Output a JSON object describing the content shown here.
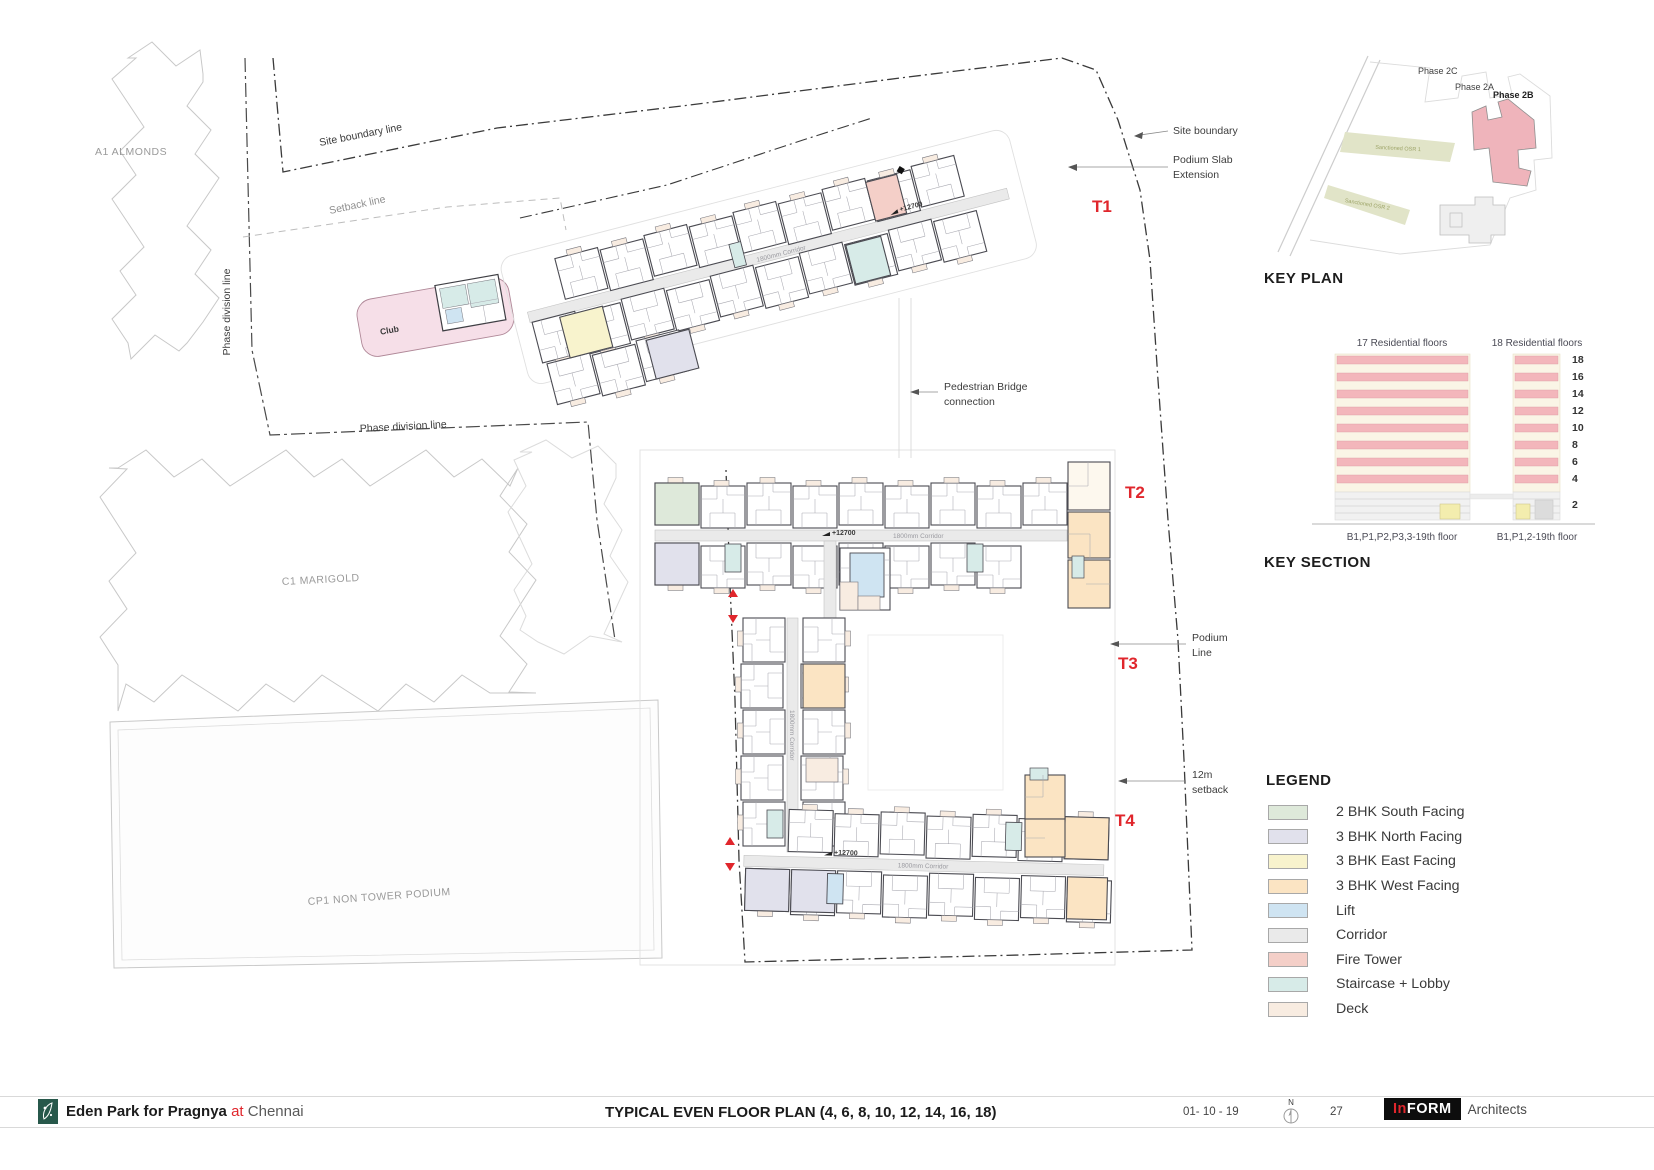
{
  "titlebar": {
    "project": "Eden Park for Pragnya",
    "at": "at",
    "city": "Chennai",
    "drawing_title": "TYPICAL EVEN FLOOR PLAN (4, 6, 8, 10, 12, 14, 16, 18)",
    "date": "01- 10 - 19",
    "north": "N",
    "sheet": "27",
    "firm_in": "In",
    "firm_form": "FORM",
    "firm_suffix": "Architects"
  },
  "key_plan": {
    "title": "KEY PLAN",
    "phase_2c": "Phase 2C",
    "phase_2a": "Phase 2A",
    "phase_2b": "Phase 2B",
    "osr1": "Sanctioned OSR 1",
    "osr2": "Sanctioned OSR 2",
    "highlight_color": "#efb4bb"
  },
  "key_section": {
    "title": "KEY SECTION",
    "left_header": "17 Residential floors",
    "right_header": "18 Residential floors",
    "left_caption": "B1,P1,P2,P3,3-19th floor",
    "right_caption": "B1,P1,2-19th floor",
    "floors": [
      "18",
      "16",
      "14",
      "12",
      "10",
      "8",
      "6",
      "4",
      "2"
    ],
    "band_color": "#f3b6bb",
    "body_color": "#faf5e6"
  },
  "legend": {
    "title": "LEGEND",
    "items": [
      {
        "label": "2 BHK South Facing",
        "color": "#dee9da"
      },
      {
        "label": "3 BHK North Facing",
        "color": "#e1e1ec"
      },
      {
        "label": "3 BHK East Facing",
        "color": "#f8f3cd"
      },
      {
        "label": "3 BHK West Facing",
        "color": "#fbe4c3"
      },
      {
        "label": "Lift",
        "color": "#cfe4f2"
      },
      {
        "label": "Corridor",
        "color": "#eaeaea"
      },
      {
        "label": "Fire Tower",
        "color": "#f4cfc8"
      },
      {
        "label": "Staircase + Lobby",
        "color": "#d7ebe8"
      },
      {
        "label": "Deck",
        "color": "#f8ece1"
      }
    ]
  },
  "plan": {
    "towers": {
      "t1": "T1",
      "t2": "T2",
      "t3": "T3",
      "t4": "T4"
    },
    "annotations": {
      "site_boundary": "Site boundary",
      "podium_slab_1": "Podium Slab",
      "podium_slab_2": "Extension",
      "pedestrian_1": "Pedestrian Bridge",
      "pedestrian_2": "connection",
      "podium_line_1": "Podium",
      "podium_line_2": "Line",
      "setback_12m_1": "12m",
      "setback_12m_2": "setback",
      "site_boundary_line": "Site boundary line",
      "setback_line": "Setback line",
      "phase_division_line": "Phase division line"
    },
    "context": {
      "a1": "A1 ALMONDS",
      "c1": "C1 MARIGOLD",
      "cp1": "CP1 NON TOWER PODIUM",
      "club": "Club"
    },
    "corridor_label": "1800mm Corridor",
    "level_marker": "+12700",
    "accent_red": "#e0262c"
  }
}
